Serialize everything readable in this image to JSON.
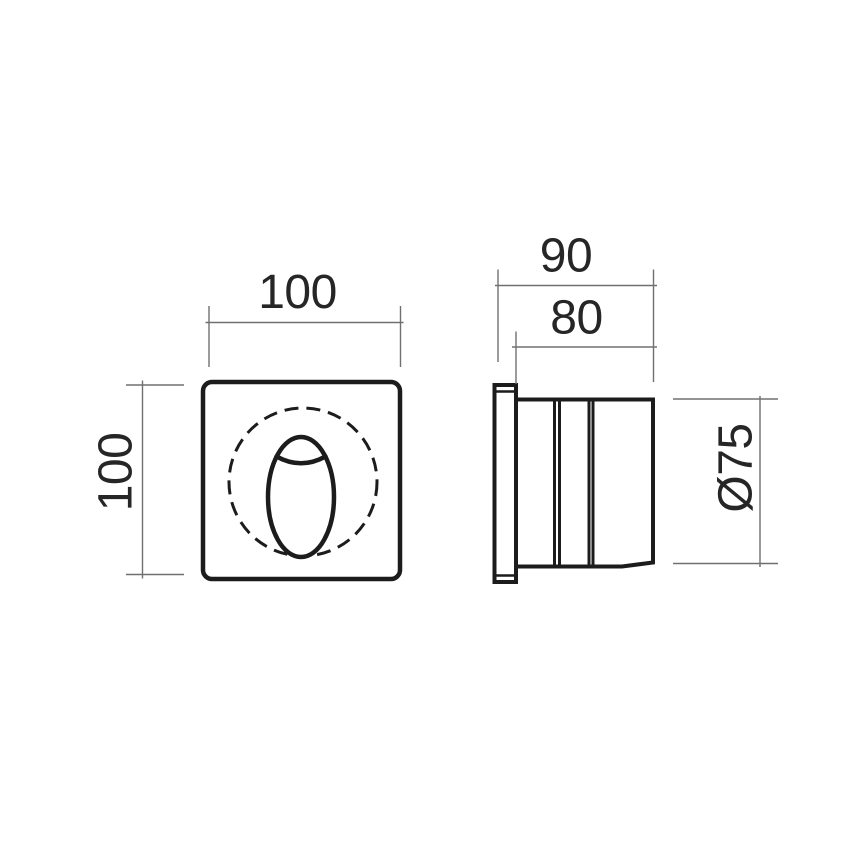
{
  "drawing": {
    "kind": "technical-dimension-drawing",
    "colors": {
      "background": "#ffffff",
      "object_line": "#1c1c1c",
      "dimension_line": "#707070",
      "dimension_text": "#262626"
    },
    "front_view": {
      "width_label": "100",
      "height_label": "100"
    },
    "side_view": {
      "overall_depth_label": "90",
      "body_depth_label": "80",
      "diameter_label": "Ø75"
    }
  }
}
